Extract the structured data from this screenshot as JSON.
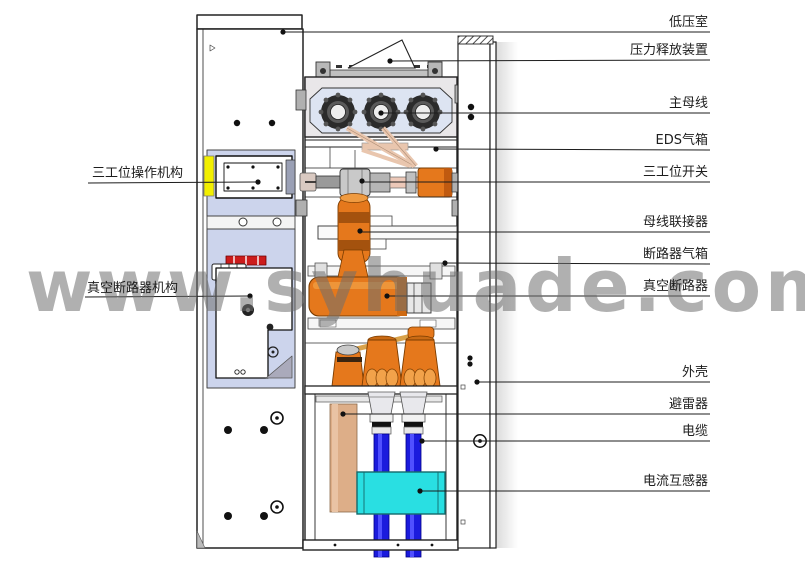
{
  "watermark": {
    "text": "www.syhuade.com"
  },
  "labels": {
    "right": [
      {
        "id": "low-voltage-room",
        "text": "低压室"
      },
      {
        "id": "pressure-release",
        "text": "压力释放装置"
      },
      {
        "id": "main-busbar",
        "text": "主母线"
      },
      {
        "id": "eds-gas-tank",
        "text": "EDS气箱"
      },
      {
        "id": "three-position-switch",
        "text": "三工位开关"
      },
      {
        "id": "busbar-connector",
        "text": "母线联接器"
      },
      {
        "id": "breaker-gas-tank",
        "text": "断路器气箱"
      },
      {
        "id": "vacuum-breaker",
        "text": "真空断路器"
      },
      {
        "id": "enclosure",
        "text": "外壳"
      },
      {
        "id": "surge-arrester",
        "text": "避雷器"
      },
      {
        "id": "cable",
        "text": "电缆"
      },
      {
        "id": "current-transformer",
        "text": "电流互感器"
      }
    ],
    "left": [
      {
        "id": "three-position-mechanism",
        "text": "三工位操作机构"
      },
      {
        "id": "vcb-mechanism",
        "text": "真空断路器机构"
      }
    ]
  },
  "colors": {
    "insulator_orange": "#e5781c",
    "insulator_orange_dark": "#c05a10",
    "cable_blue": "#1b1bdd",
    "ct_cyan": "#29dfe2",
    "arrester_tan": "#ddae88",
    "panel_lavender": "#ccd4ec",
    "busbar_tube_tan": "#e9c6ae",
    "marker_yellow": "#f2ef00",
    "mechanism_red": "#cc1c1c",
    "watermark_gray": "#707070"
  }
}
